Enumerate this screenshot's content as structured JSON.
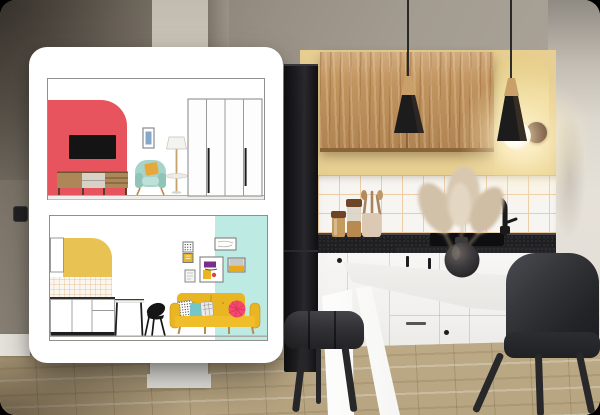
{
  "meta": {
    "description": "Promotional visual: photo of a modern kitchen with two black pendant lamps, wooden upper cabinet, black fridge, white base cabinets, white table and two black chairs; a white rounded design-board card overlays the left side showing two interior elevation drawings (living room with red accent arch, and kitchen/living zone with yellow arch and mustard sofa). No text is present in the image.",
    "aria": {
      "stage": "kitchen interior photo with interior-design board overlay",
      "card": "design board with two room elevation drawings",
      "drawing_top": "living room elevation: red arched accent wall with TV, wooden sideboard, framed art, teal armchair, floor lamp, white wardrobe",
      "drawing_bottom": "kitchen elevation: yellow arched accent, tiled backsplash, white cabinets, table and chair silhouette, gallery wall, mustard sofa with pillows on mint background",
      "photo": "kitchen with oak wall cabinet, pendant lights, glowing sconce in painted arch niche, black fridge, pampas grass in round vase, white table, black chairs"
    }
  },
  "overlay_card": {
    "drawings": [
      {
        "id": "living-room-elevation",
        "elements": [
          "red accent wall with rounded arch",
          "black tv",
          "wooden sideboard",
          "framed blue art",
          "teal armchair with mustard pillow",
          "floor lamp with tray",
          "four-door wardrobe with black handles"
        ]
      },
      {
        "id": "kitchen-elevation",
        "elements": [
          "tall white cabinet",
          "yellow rounded arch",
          "tiled backsplash",
          "white base cabinets with black kickboard",
          "table",
          "black chair silhouette",
          "gallery wall of six frames",
          "mustard sofa with patterned, teal, plaid and pink pillows",
          "mint color block"
        ]
      }
    ]
  },
  "photo": {
    "elements": [
      "grey wall",
      "cream pillar",
      "light switch",
      "black fridge",
      "oak wall cabinet",
      "two black cone pendant lamps with wooden tops",
      "painted yellow arch niche",
      "glowing globe wall sconce on wooden plate",
      "white tile backsplash with peach grout",
      "black speckled countertop with sink and black faucet",
      "storage jars and utensil crock",
      "pampas grass in dark round vase",
      "white base cabinets",
      "white table with angled legs",
      "two black upholstered chairs",
      "light oak plank floor"
    ]
  },
  "colors": {
    "card_bg": "#ffffff",
    "wall_dark": "#776f64",
    "wall_yellow": "#e7cf92",
    "arch_photo_yellow": "#eedc9f",
    "tile_white": "#f7f5f1",
    "tile_grout": "#eccda6",
    "wood_cabinet": "#c2945f",
    "counter_black": "#1f1e20",
    "cabinet_white": "#f4f3f1",
    "kickboard": "#9aa0a3",
    "fridge_black": "#1b1b1e",
    "floor_base": "#c7b493",
    "table_white": "#fcfcfb",
    "chair_dark": "#2b2c2f",
    "lamp_black": "#1c1c1c",
    "lamp_wood": "#c9a06a",
    "glow_warm": "#fff1c8",
    "red_shape": "#e8545d",
    "tv_black": "#141414",
    "sideboard_wood": "#ad8757",
    "drawer_beige": "#d8d1c6",
    "armchair_teal": "#a7d4ca",
    "pillow_mustard": "#e8a73b",
    "wardrobe_line": "#8f8f8f",
    "mint_block": "#bdeae2",
    "draw_arch_yellow": "#e9c254",
    "draw_grout": "#e7b57b",
    "sofa_yellow": "#e9b522",
    "pillow_teal": "#74c7c9",
    "pillow_pink": "#f4486f",
    "silhouette_black": "#151515",
    "frame_grey": "#7f7f7f",
    "art_purple": "#7b2d8e"
  }
}
